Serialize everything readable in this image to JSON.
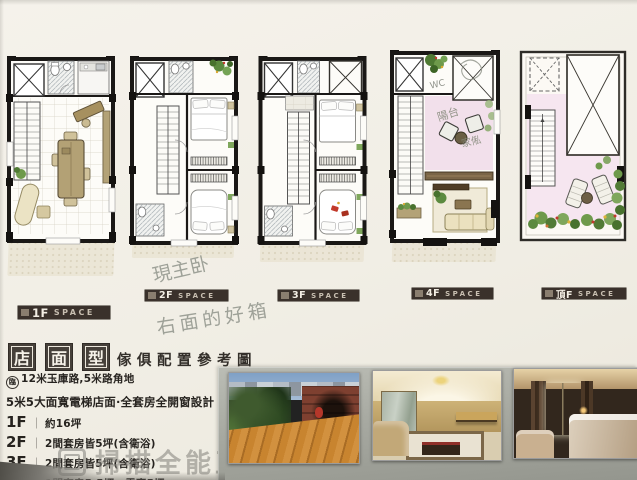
{
  "document": {
    "floor_plans": [
      {
        "floor": "1F",
        "space": "SPACE"
      },
      {
        "floor": "2F",
        "space": "SPACE"
      },
      {
        "floor": "3F",
        "space": "SPACE"
      },
      {
        "floor": "4F",
        "space": "SPACE"
      },
      {
        "floor": "頂F",
        "space": "SPACE"
      }
    ],
    "handwritten_notes": {
      "master_bedroom": "現主卧",
      "right_side": "右面的好箱",
      "wc": "WC",
      "balcony": "陽台",
      "furniture": "家俬"
    },
    "title_block": {
      "boxed_characters": [
        "店",
        "面",
        "型"
      ],
      "subtitle": "傢俱配置參考圖"
    },
    "specs": {
      "road_prefix": "臨",
      "road_line": "12米玉庫路,5米路角地",
      "design_line": "5米5大面寬電梯店面·全套房全開窗設計",
      "separator": "｜",
      "floor_details": [
        {
          "floor": "1F",
          "desc": "約16坪"
        },
        {
          "floor": "2F",
          "desc": "2間套房皆5坪(含衛浴)"
        },
        {
          "floor": "3F",
          "desc": "2間套房皆5坪(含衛浴)"
        },
        {
          "floor": "4F",
          "desc": "1間套房5.5坪，露臺5坪"
        }
      ]
    },
    "watermark": {
      "text": "掃描全能王 創建"
    },
    "photos": [
      {
        "name": "roof-terrace-night-photo"
      },
      {
        "name": "living-room-photo"
      },
      {
        "name": "bedroom-photo"
      }
    ],
    "colors": {
      "paper": "#f1eee5",
      "panel_gray": "#a7a9a1",
      "label_bar": "#3a312b",
      "wall_black": "#1a1816",
      "plan_pink": "#f1dde9",
      "plant_green": "#6e9a4b",
      "wood_tan": "#b3a277"
    }
  }
}
